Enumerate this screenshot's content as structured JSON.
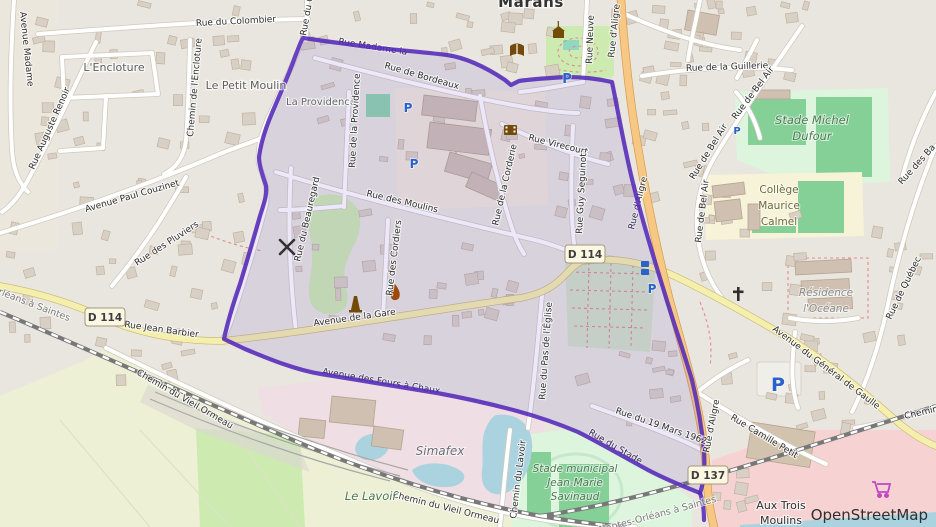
{
  "places": {
    "marans": "Marans",
    "encloture": "L'Encloture",
    "petit_moulin": "Le Petit Moulin",
    "providence": "La Providence",
    "simafex": "Simafex",
    "le_lavoir": "Le Lavoir",
    "stade_municipal_1": "Stade municipal",
    "stade_municipal_2": "Jean-Marie",
    "stade_municipal_3": "Savinaud",
    "stade_dufour_1": "Stade Michel",
    "stade_dufour_2": "Dufour",
    "college_1": "Collège",
    "college_2": "Maurice",
    "college_3": "Calmel",
    "residence_1": "Résidence",
    "residence_2": "l'Océane",
    "trois_moulins_1": "Aux Trois",
    "trois_moulins_2": "Moulins"
  },
  "streets": {
    "colombier": "Rue du Colombier",
    "avenue_madame": "Avenue Madame",
    "auguste_renoir": "Rue Auguste Renoir",
    "chemin_encloture": "Chemin de l'Encloture",
    "rue_du_gra": "Rue du Gra",
    "providence_rue": "Rue de la Providence",
    "bordeaux": "Rue de Bordeaux",
    "madame": "Rue Madame la",
    "moulins": "Rue des Moulins",
    "beauregard": "Rue du Beauregard",
    "cordiers": "Rue des Cordiers",
    "corderie": "Rue de la Corderie",
    "virecourt": "Rue Virecourt",
    "seguinot": "Rue Guy Seguinot",
    "neuve": "Rue Neuve",
    "aligre": "Rue d'Aligre",
    "guillerie": "Rue de la Guillerie",
    "bel_air": "Rue de Bel Air",
    "quebec": "Rue de Québec",
    "rue_des_ba": "Rue des Ba",
    "gdg": "Avenue du Général de Gaulle",
    "chemin_right": "Chemin",
    "camille_petit": "Rue Camille Petit",
    "mars_1962": "Rue du 19 Mars 1962",
    "stade_street": "Rue du Stade",
    "fours": "Avenue des Fours à Chaux",
    "jean_barbier": "Rue Jean Barbier",
    "gare": "Avenue de la Gare",
    "couzinet": "Avenue Paul Couzinet",
    "pluviers": "Rue des Pluviers",
    "vieil_ormeau": "Chemin du Vieil Ormeau",
    "lavoir_chemin": "Chemin du Lavoir",
    "pas_eglise": "Rue du Pas de l'Église"
  },
  "railway": "Nantes-Orléans à Saintes",
  "badges": {
    "d114": "D 114",
    "d137": "D 137"
  },
  "attribution": "OpenStreetMap",
  "icons": {
    "parking": "P"
  },
  "colors": {
    "boundary": "#5429b8",
    "boundary_fill": "rgba(106,76,210,0.13)",
    "primary_road": "#f6c883",
    "secondary_road": "#f5efae",
    "water": "#aad3df",
    "pitch_green": "#85d097",
    "parking_blue": "#2a62c9"
  }
}
